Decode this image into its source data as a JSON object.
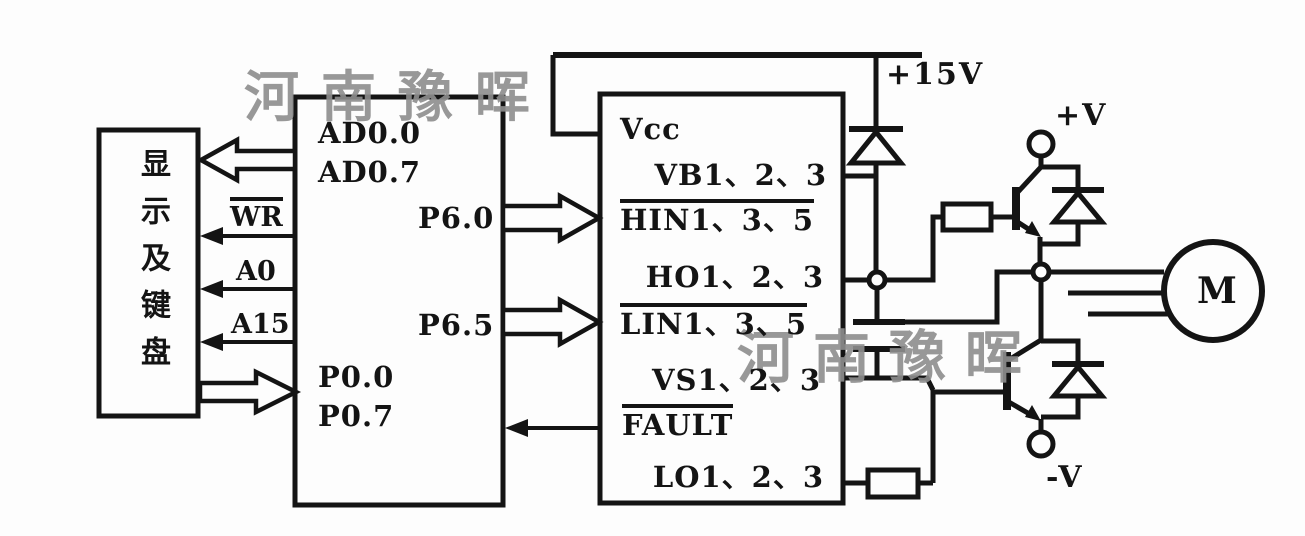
{
  "watermark": {
    "text": "河南豫晖"
  },
  "power": {
    "rail": "+15V",
    "positive": "+V",
    "negative": "-V"
  },
  "display_unit": {
    "label": "显示及键盘"
  },
  "mcu": {
    "ad_high": "AD0.0",
    "ad_low": "AD0.7",
    "p6_0": "P6.0",
    "p6_5": "P6.5",
    "p0_0": "P0.0",
    "p0_7": "P0.7"
  },
  "bus": {
    "wr": "WR",
    "a0": "A0",
    "a15": "A15"
  },
  "driver": {
    "vcc": "Vcc",
    "vb": "VB1、2、3",
    "hin": "HIN1、3、5",
    "ho": "HO1、2、3",
    "lin": "LIN1、3、5",
    "vs": "VS1、2、3",
    "fault": "FAULT",
    "lo": "LO1、2、3"
  },
  "motor": {
    "label": "M"
  }
}
